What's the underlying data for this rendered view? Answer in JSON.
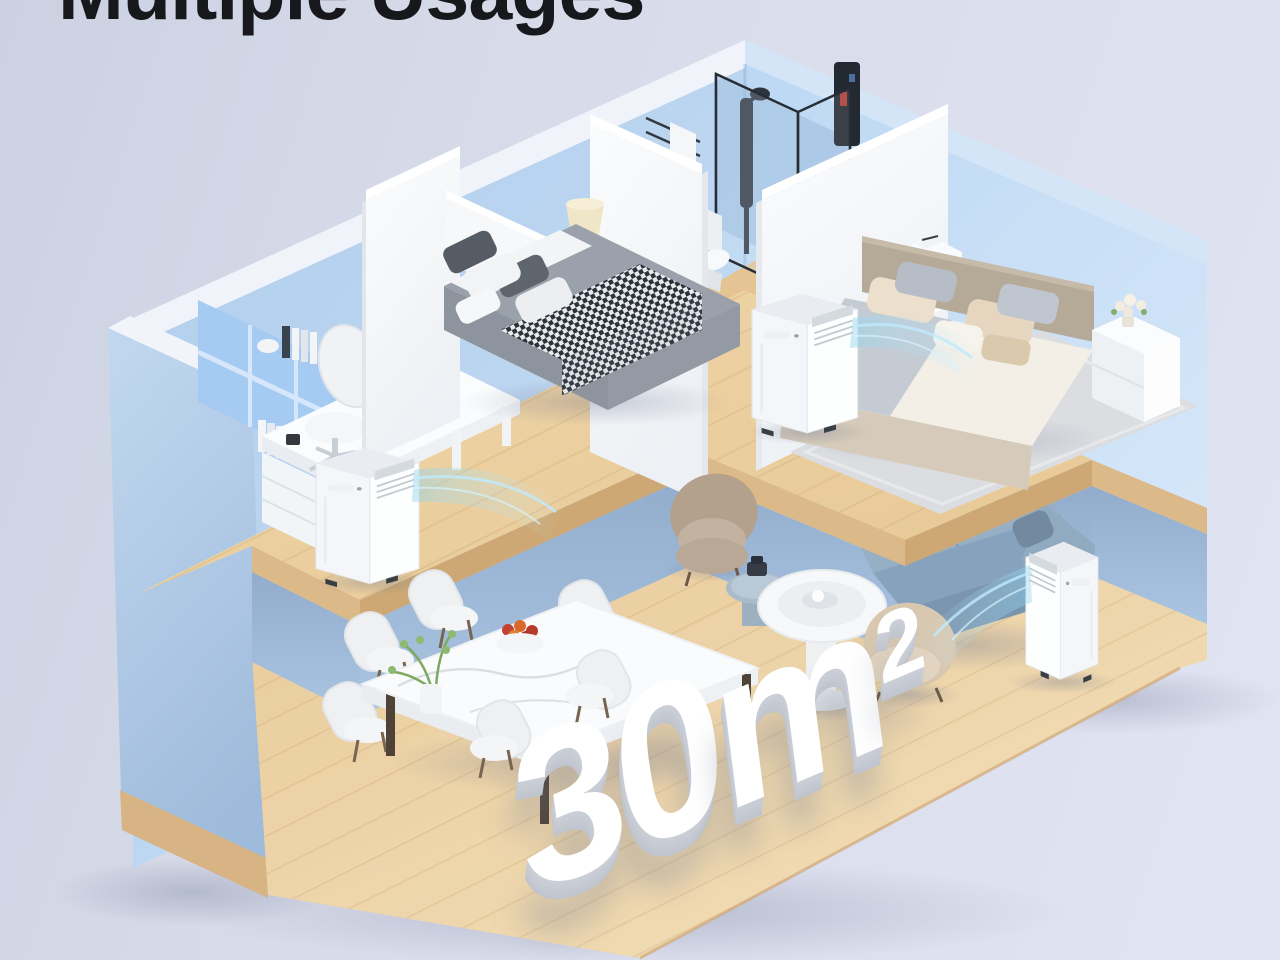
{
  "headline": {
    "text": "Multiple Usages"
  },
  "scene": {
    "type": "isometric-apartment-cutaway",
    "area_label": {
      "value": "30",
      "unit": "m",
      "superscript": "2",
      "display": "30m²"
    },
    "air_conditioner_count": 3,
    "rooms": [
      {
        "name": "home-office",
        "items": [
          "built-in-bookshelf",
          "books",
          "vase",
          "computer-mouse",
          "l-shaped-desk",
          "monitor",
          "keyboard",
          "office-chair",
          "drawer-cabinet",
          "portable-air-conditioner"
        ]
      },
      {
        "name": "bedroom-1",
        "items": [
          "double-bed",
          "gray-bedding",
          "houndstooth-throw",
          "pillows",
          "white-headboard",
          "nightstand",
          "table-lamp"
        ]
      },
      {
        "name": "bathroom",
        "items": [
          "glass-shower-enclosure",
          "shower-column",
          "towel-rack",
          "towel",
          "black-wall-panel",
          "toilet"
        ]
      },
      {
        "name": "bedroom-2",
        "items": [
          "double-bed",
          "beige-bedding",
          "pillows",
          "nightstand-with-book",
          "nightstand-with-flowers",
          "area-rug",
          "portable-air-conditioner"
        ]
      },
      {
        "name": "living-room",
        "items": [
          "blue-sofa",
          "throw-pillows",
          "round-coffee-table",
          "side-table",
          "armchair-taupe",
          "armchair-beige",
          "portable-air-conditioner"
        ]
      },
      {
        "name": "dining-room",
        "items": [
          "marble-dining-table",
          "dining-chairs-x6",
          "potted-plant",
          "fruit-bowl"
        ]
      }
    ],
    "colors": {
      "background": "#dcdfee",
      "headline_text": "#17181b",
      "wall_blue": "#b9d4f0",
      "wall_blue_outer": "#aac4e1",
      "partition_white": "#f6f8fa",
      "floor_wood": "#ebcfa0",
      "floor_wood_edge": "#d9b583",
      "sofa_blue": "#8ba6bf",
      "airflow": "#a8e0f2",
      "area_text": "#ffffff"
    }
  }
}
